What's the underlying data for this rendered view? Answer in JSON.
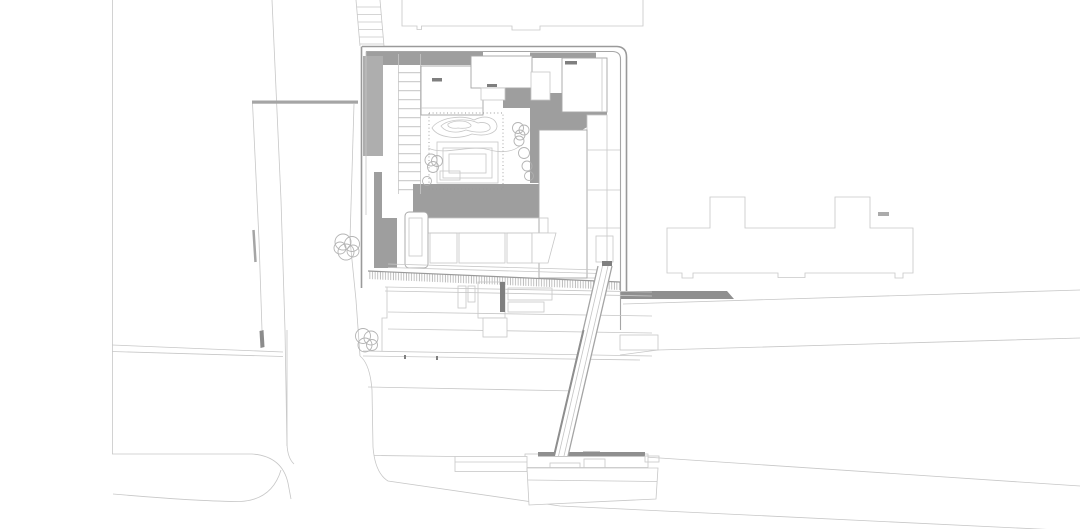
{
  "scene": {
    "kind": "architectural site plan (top view line drawing)",
    "parts": [
      "street-grid",
      "neighbor-building-north",
      "neighbor-building-east",
      "main-building-site",
      "roof-shadows",
      "louvered-roof",
      "courtyard-pond",
      "terraced-steps",
      "pedestrian-bridge",
      "waterfront-pier",
      "trees"
    ]
  },
  "colors": {
    "background": "#ffffff",
    "line_light": "#c7c7c7",
    "line_medium": "#a6a6a6",
    "line_wall": "#9a9a9a",
    "line_dark": "#8f8f8f",
    "shadow_dark": "#9e9e9e",
    "shadow_medium": "#aeaeae",
    "accent_dark": "#7f7f7f",
    "hatch": "#9f9f9f",
    "tree": "#b0b0b0"
  }
}
